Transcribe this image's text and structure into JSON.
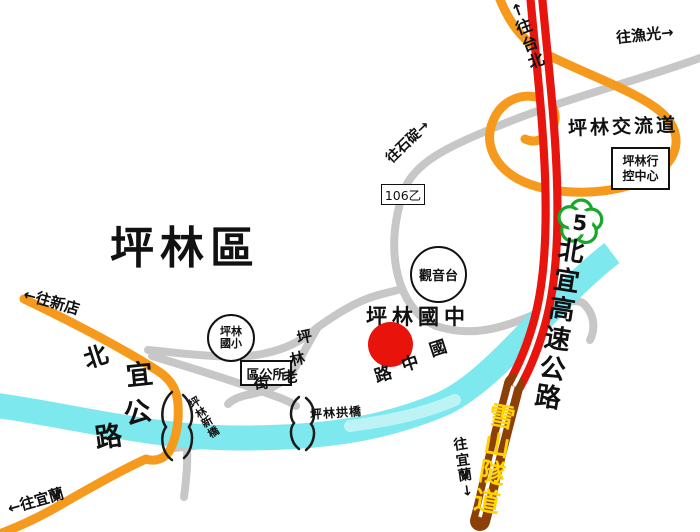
{
  "labels": {
    "district_title": "坪林區",
    "toward_taipei": "↑往台北",
    "toward_yuguang": "往漁光→",
    "interchange": "坪林交流道",
    "control_center_line1": "坪林行",
    "control_center_line2": "控中心",
    "hwy5": "5",
    "beiyi_expressway": "北宜高速公路",
    "snow_tunnel": "雪山隧道",
    "toward_yilan_right": "往宜蘭↓",
    "toward_yilan_left": "←往宜蘭",
    "toward_xindian": "←往新店",
    "toward_shiding": "往石碇→",
    "route_106b": "106乙",
    "guanyin_platform": "觀音台",
    "pinglin_jhs": "坪林國中",
    "pinglin_es_line1": "坪林",
    "pinglin_es_line2": "國小",
    "district_office": "區公所",
    "arch_bridge": "坪林拱橋",
    "new_bridge": "坪林新橋",
    "old_street": {
      "c1": "坪",
      "c2": "林",
      "c3": "老",
      "c4": "街"
    },
    "guozhong_rd": {
      "c1": "國",
      "c2": "中",
      "c3": "路"
    },
    "beiyi_name": {
      "c1": "北",
      "c2": "宜",
      "c3": "公",
      "c4": "路"
    }
  },
  "colors": {
    "highway_red": "#e8150e",
    "tunnel_brown": "#8d3f08",
    "tunnel_text_yellow": "#ffd400",
    "provincial_orange": "#f59a1d",
    "local_road_gray": "#c7c7c7",
    "river_cyan": "#7de9ef",
    "shield_green": "#17a82c",
    "school_marker_red": "#e8130b",
    "text_black": "#111111"
  }
}
